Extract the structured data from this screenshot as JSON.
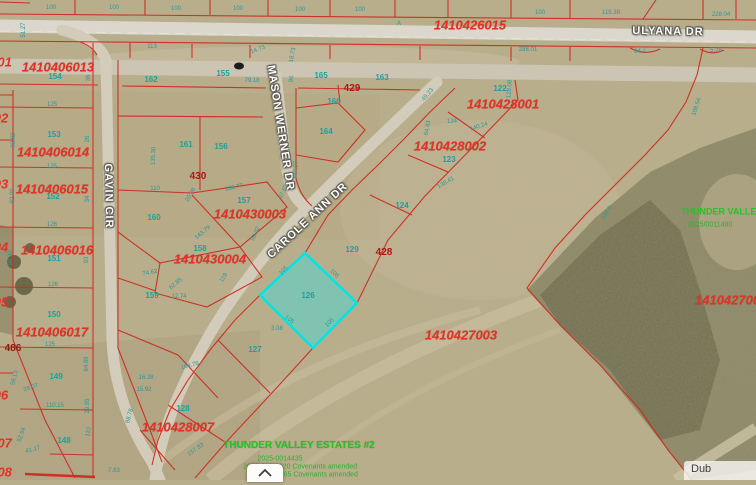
{
  "map": {
    "description": "County GIS aerial parcel map",
    "colors": {
      "parcel_line": "#cf2b20",
      "highlight_fill": "#50d6cd",
      "highlight_stroke": "#00e5e5",
      "lot_number_teal": "#1fa0a0",
      "subdivision_green": "#25c325",
      "field_tan": "#b9ae8c",
      "road_gray": "#d6d2c6"
    },
    "highlighted_parcel": {
      "lot": "126",
      "shape": "diamond"
    },
    "parcel_ids": [
      {
        "text": "1410426015",
        "x": 470,
        "y": 25
      },
      {
        "text": "1410406013",
        "x": 58,
        "y": 67
      },
      {
        "text": "1410406014",
        "x": 53,
        "y": 152
      },
      {
        "text": "1410406015",
        "x": 52,
        "y": 189
      },
      {
        "text": "1410406016",
        "x": 57,
        "y": 250
      },
      {
        "text": "1410406017",
        "x": 52,
        "y": 332
      },
      {
        "text": "1410428001",
        "x": 503,
        "y": 104
      },
      {
        "text": "1410428002",
        "x": 450,
        "y": 146
      },
      {
        "text": "1410430003",
        "x": 250,
        "y": 214
      },
      {
        "text": "1410430004",
        "x": 210,
        "y": 259
      },
      {
        "text": "1410428007",
        "x": 178,
        "y": 427
      },
      {
        "text": "1410427003",
        "x": 461,
        "y": 335
      },
      {
        "text": "1410427005",
        "x": 695,
        "y": 300,
        "edge": "left"
      }
    ],
    "partial_parcel_ids": [
      {
        "text": "001",
        "x": 1,
        "y": 62
      },
      {
        "text": "02",
        "x": 1,
        "y": 118
      },
      {
        "text": "03",
        "x": 1,
        "y": 184
      },
      {
        "text": "04",
        "x": 1,
        "y": 247
      },
      {
        "text": "05",
        "x": 1,
        "y": 302
      },
      {
        "text": "06",
        "x": 1,
        "y": 395
      },
      {
        "text": "007",
        "x": 1,
        "y": 443
      },
      {
        "text": "008",
        "x": 1,
        "y": 472
      }
    ],
    "address_labels": [
      {
        "text": "429",
        "x": 352,
        "y": 89
      },
      {
        "text": "430",
        "x": 198,
        "y": 177
      },
      {
        "text": "428",
        "x": 384,
        "y": 253
      },
      {
        "text": "486",
        "x": 13,
        "y": 349,
        "dark": true
      }
    ],
    "street_names": [
      {
        "text": "ULYANA DR",
        "x": 668,
        "y": 32,
        "rot": 1
      },
      {
        "text": "GAVIN CIR",
        "x": 108,
        "y": 196,
        "rot": 89
      },
      {
        "text": "MASON WERNER DR",
        "x": 280,
        "y": 128,
        "rot": 81
      },
      {
        "text": "CAROLE ANN DR",
        "x": 308,
        "y": 221,
        "rot": -43
      }
    ],
    "lot_numbers": [
      {
        "text": "154",
        "x": 55,
        "y": 77
      },
      {
        "text": "153",
        "x": 54,
        "y": 135
      },
      {
        "text": "152",
        "x": 53,
        "y": 197
      },
      {
        "text": "151",
        "x": 54,
        "y": 259
      },
      {
        "text": "150",
        "x": 54,
        "y": 315
      },
      {
        "text": "149",
        "x": 56,
        "y": 377
      },
      {
        "text": "148",
        "x": 64,
        "y": 441
      },
      {
        "text": "162",
        "x": 151,
        "y": 80
      },
      {
        "text": "155",
        "x": 223,
        "y": 74
      },
      {
        "text": "161",
        "x": 186,
        "y": 145
      },
      {
        "text": "156",
        "x": 221,
        "y": 147
      },
      {
        "text": "160",
        "x": 154,
        "y": 218
      },
      {
        "text": "157",
        "x": 244,
        "y": 201
      },
      {
        "text": "159",
        "x": 152,
        "y": 296
      },
      {
        "text": "158",
        "x": 200,
        "y": 249
      },
      {
        "text": "163",
        "x": 382,
        "y": 78
      },
      {
        "text": "165",
        "x": 321,
        "y": 76
      },
      {
        "text": "166",
        "x": 334,
        "y": 102
      },
      {
        "text": "164",
        "x": 326,
        "y": 132
      },
      {
        "text": "122",
        "x": 500,
        "y": 89
      },
      {
        "text": "123",
        "x": 449,
        "y": 160
      },
      {
        "text": "124",
        "x": 402,
        "y": 206
      },
      {
        "text": "129",
        "x": 352,
        "y": 250
      },
      {
        "text": "126",
        "x": 308,
        "y": 296
      },
      {
        "text": "127",
        "x": 255,
        "y": 350
      },
      {
        "text": "128",
        "x": 183,
        "y": 409
      }
    ],
    "dimension_labels": [
      {
        "text": "100",
        "x": 51,
        "y": 8
      },
      {
        "text": "100",
        "x": 114,
        "y": 8
      },
      {
        "text": "100",
        "x": 176,
        "y": 9
      },
      {
        "text": "100",
        "x": 238,
        "y": 9
      },
      {
        "text": "100",
        "x": 300,
        "y": 10
      },
      {
        "text": "100",
        "x": 360,
        "y": 10
      },
      {
        "text": "100",
        "x": 540,
        "y": 13
      },
      {
        "text": "119.38",
        "x": 611,
        "y": 13
      },
      {
        "text": "228.04",
        "x": 721,
        "y": 15
      },
      {
        "text": "A",
        "x": 399,
        "y": 24
      },
      {
        "text": "51.27",
        "x": 24,
        "y": 30,
        "rot": -90
      },
      {
        "text": "113",
        "x": 152,
        "y": 47
      },
      {
        "text": "14.73",
        "x": 258,
        "y": 50,
        "rot": -20
      },
      {
        "text": "288.01",
        "x": 528,
        "y": 50
      },
      {
        "text": "84.1",
        "x": 640,
        "y": 52
      },
      {
        "text": "5.28",
        "x": 716,
        "y": 51
      },
      {
        "text": "188.54",
        "x": 697,
        "y": 107,
        "rot": -72
      },
      {
        "text": "134.6",
        "x": 607,
        "y": 213,
        "rot": -55
      },
      {
        "text": "79.18",
        "x": 252,
        "y": 81
      },
      {
        "text": "36",
        "x": 89,
        "y": 78,
        "rot": -90
      },
      {
        "text": "125",
        "x": 52,
        "y": 105
      },
      {
        "text": "93.02",
        "x": 14,
        "y": 140,
        "rot": -90
      },
      {
        "text": "26",
        "x": 88,
        "y": 139,
        "rot": -90
      },
      {
        "text": "125",
        "x": 52,
        "y": 167
      },
      {
        "text": "92.00",
        "x": 13,
        "y": 196,
        "rot": -90
      },
      {
        "text": "34",
        "x": 88,
        "y": 199,
        "rot": -90
      },
      {
        "text": "126",
        "x": 52,
        "y": 225
      },
      {
        "text": "98.30",
        "x": 11,
        "y": 258,
        "rot": -90
      },
      {
        "text": "93",
        "x": 87,
        "y": 260,
        "rot": -90
      },
      {
        "text": "126",
        "x": 53,
        "y": 285
      },
      {
        "text": "125",
        "x": 50,
        "y": 345
      },
      {
        "text": "64.89",
        "x": 87,
        "y": 364,
        "rot": -90
      },
      {
        "text": "58.13",
        "x": 15,
        "y": 378,
        "rot": -75
      },
      {
        "text": "28.07",
        "x": 31,
        "y": 388,
        "rot": -20
      },
      {
        "text": "110.15",
        "x": 55,
        "y": 406
      },
      {
        "text": "29.95",
        "x": 88,
        "y": 406,
        "rot": -90
      },
      {
        "text": "52.94",
        "x": 22,
        "y": 435,
        "rot": -70
      },
      {
        "text": "41.17",
        "x": 33,
        "y": 450,
        "rot": -15
      },
      {
        "text": "110",
        "x": 89,
        "y": 432,
        "rot": -80
      },
      {
        "text": "7.63",
        "x": 114,
        "y": 471
      },
      {
        "text": "135.30",
        "x": 154,
        "y": 156,
        "rot": -88
      },
      {
        "text": "110",
        "x": 155,
        "y": 189
      },
      {
        "text": "20.98",
        "x": 191,
        "y": 195,
        "rot": -60
      },
      {
        "text": "136.77",
        "x": 234,
        "y": 188,
        "rot": -12
      },
      {
        "text": "97.63",
        "x": 284,
        "y": 192,
        "rot": -65
      },
      {
        "text": "143.79",
        "x": 203,
        "y": 233,
        "rot": -40
      },
      {
        "text": "99.32",
        "x": 256,
        "y": 234,
        "rot": -65
      },
      {
        "text": "74.62",
        "x": 150,
        "y": 273,
        "rot": -10
      },
      {
        "text": "62.85",
        "x": 176,
        "y": 284,
        "rot": -40
      },
      {
        "text": "12.74",
        "x": 179,
        "y": 297
      },
      {
        "text": "119",
        "x": 224,
        "y": 278,
        "rot": -55
      },
      {
        "text": "3.08",
        "x": 277,
        "y": 329
      },
      {
        "text": "164.76",
        "x": 190,
        "y": 366,
        "rot": -15
      },
      {
        "text": "16.28",
        "x": 146,
        "y": 378
      },
      {
        "text": "15.92",
        "x": 144,
        "y": 390
      },
      {
        "text": "98.78",
        "x": 130,
        "y": 416,
        "rot": -75
      },
      {
        "text": "157.83",
        "x": 196,
        "y": 450,
        "rot": -35
      },
      {
        "text": "96",
        "x": 292,
        "y": 79,
        "rot": -80
      },
      {
        "text": "18.73",
        "x": 293,
        "y": 55,
        "rot": -80
      },
      {
        "text": "128.08",
        "x": 510,
        "y": 89,
        "rot": -85
      },
      {
        "text": "140.24",
        "x": 479,
        "y": 127,
        "rot": -18
      },
      {
        "text": "64.43",
        "x": 428,
        "y": 128,
        "rot": -80
      },
      {
        "text": "138.41",
        "x": 446,
        "y": 183,
        "rot": -30
      },
      {
        "text": "124",
        "x": 452,
        "y": 122
      },
      {
        "text": "127.97",
        "x": 296,
        "y": 170,
        "rot": -85
      },
      {
        "text": "49.23",
        "x": 428,
        "y": 95,
        "rot": -50
      },
      {
        "text": "105",
        "x": 284,
        "y": 271,
        "rot": -45
      },
      {
        "text": "105",
        "x": 334,
        "y": 274,
        "rot": 43
      },
      {
        "text": "105",
        "x": 289,
        "y": 320,
        "rot": 40
      },
      {
        "text": "105",
        "x": 330,
        "y": 323,
        "rot": -45
      }
    ],
    "green_annotations": {
      "right_title": {
        "text": "THUNDER VALLEY ESTATES",
        "x": 681,
        "y": 212,
        "edge": "left"
      },
      "right_sub": {
        "text": "2025/0011480",
        "x": 688,
        "y": 225,
        "edge": "left"
      },
      "bottom_title": {
        "text": "THUNDER VALLEY ESTATES #2",
        "x": 299,
        "y": 446
      },
      "bottom_lines": [
        {
          "text": "2025-0014435",
          "x": 280,
          "y": 459
        },
        {
          "text": "2021-886-3020 Covenants amended",
          "x": 300,
          "y": 467
        },
        {
          "text": "2017-17765 Covenants amended",
          "x": 306,
          "y": 475
        }
      ]
    }
  },
  "ui": {
    "expand_button": {
      "icon": "chevron-up-icon"
    },
    "attribution": {
      "text": "Dub"
    }
  }
}
